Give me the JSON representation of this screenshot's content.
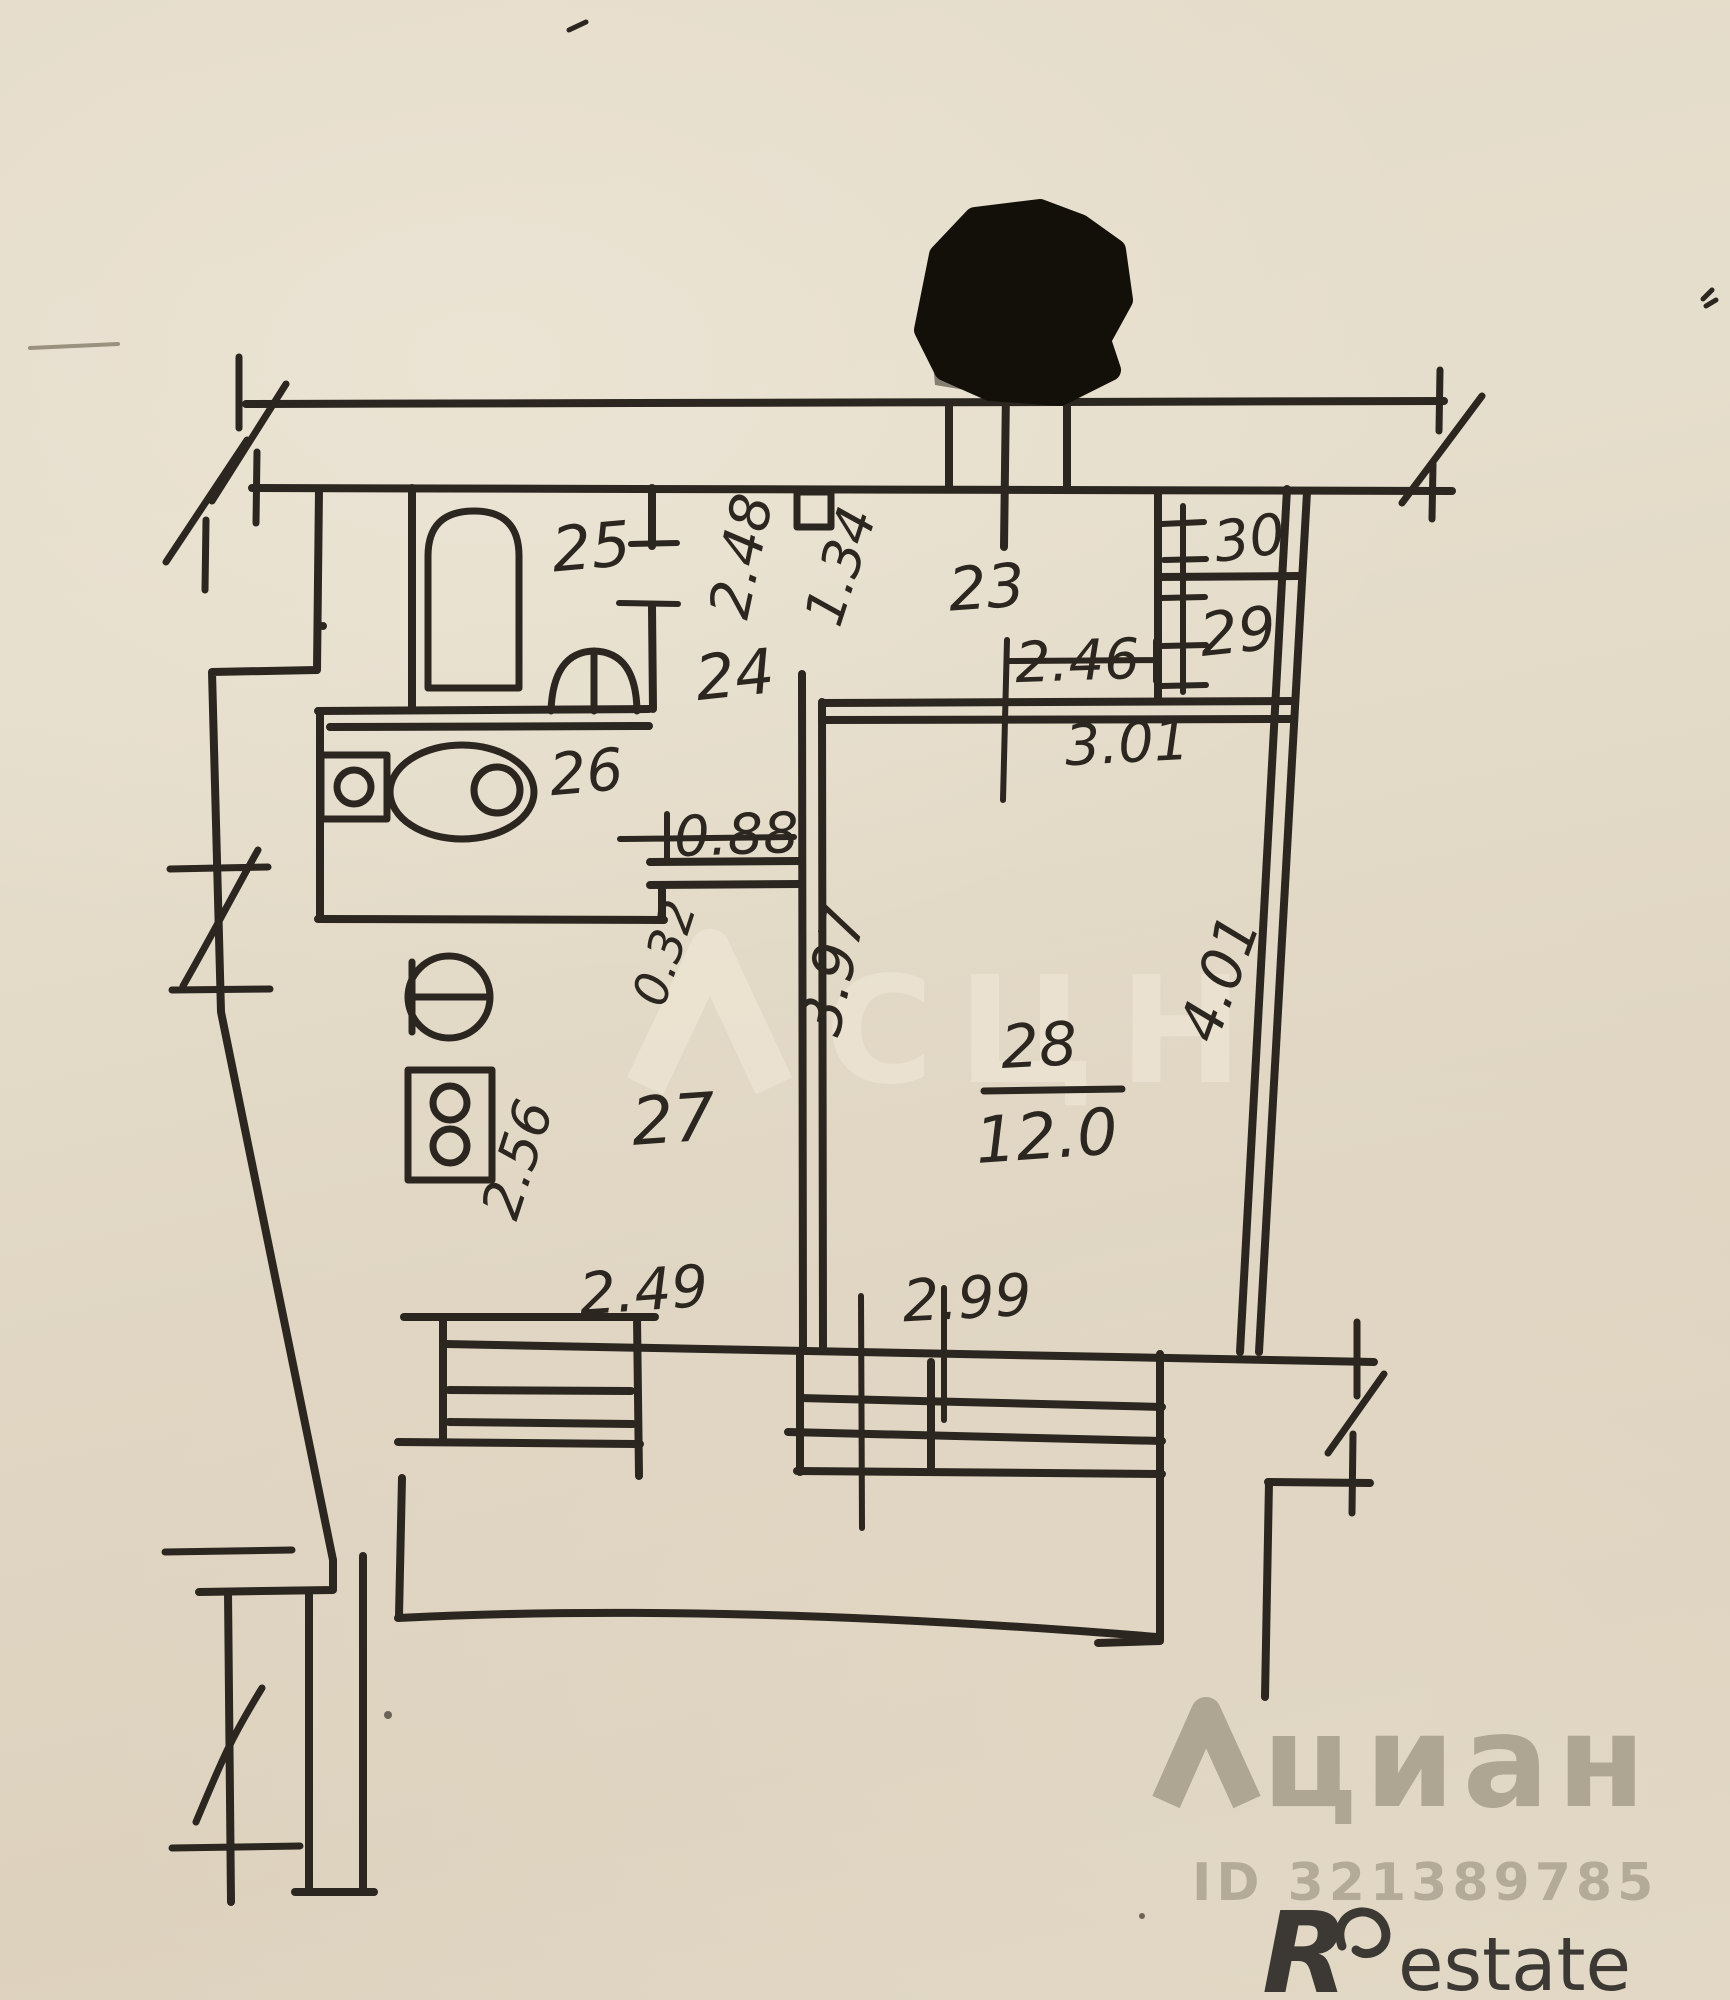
{
  "document": {
    "kind": "hand-drawn apartment floor plan (BTI technical plan scan)",
    "paper_color": "#e3dac7",
    "ink_color": "#2b261f"
  },
  "rooms": [
    {
      "number": "23",
      "note": "entrance hall"
    },
    {
      "number": "24",
      "note": "corridor"
    },
    {
      "number": "25",
      "note": "bathroom with tub and washbasin"
    },
    {
      "number": "26",
      "note": "toilet"
    },
    {
      "number": "27",
      "note": "kitchen with sink and stove"
    },
    {
      "number": "28",
      "note": "living room",
      "area": "12.0"
    },
    {
      "number": "29",
      "note": "closet"
    },
    {
      "number": "30",
      "note": "closet"
    }
  ],
  "labels": {
    "room23": "23",
    "room24": "24",
    "room25": "25",
    "room26": "26",
    "room27": "27",
    "room28": "28",
    "room29": "29",
    "room30": "30",
    "area28": "12.0"
  },
  "dimensions": {
    "d248": "2.48",
    "d134": "1.34",
    "d246": "2.46",
    "d301": "3.01",
    "d088": "0.88",
    "d032": "0.32",
    "d397": "3.97",
    "d401": "4.01",
    "d256": "2.56",
    "d249": "2.49",
    "d299": "2.99"
  },
  "watermarks": {
    "center_text": "СЦН",
    "brand_text": "циан",
    "id_text": "ID 321389785",
    "restate_r": "R",
    "restate_suffix": "estate"
  },
  "colors": {
    "paper": "#e3dac7",
    "ink": "#2b261f",
    "redaction": "#121009",
    "watermark_light": "#f2ead9",
    "watermark_gray": "#7d7564",
    "restate": "#3c3833"
  }
}
